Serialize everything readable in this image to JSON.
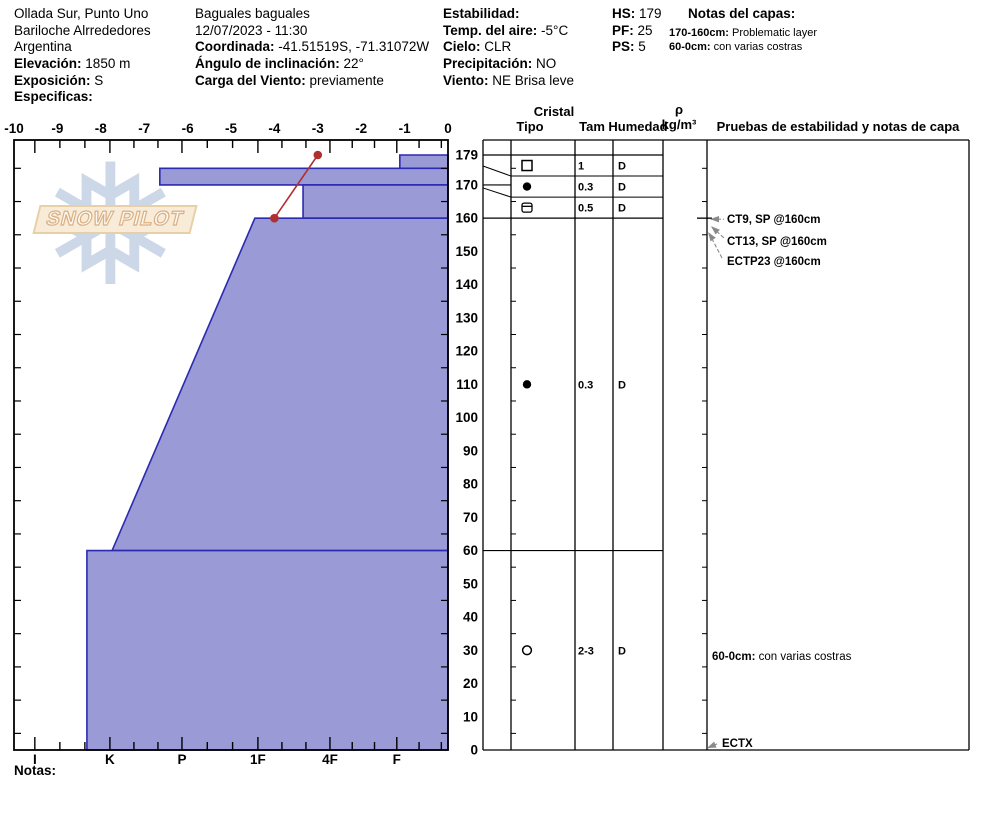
{
  "header": {
    "location": {
      "name": "Ollada Sur, Punto Uno",
      "region": "Bariloche Alrrededores",
      "country": "Argentina",
      "elevation_label": "Elevación:",
      "elevation_value": "1850 m",
      "aspect_label": "Exposición:",
      "aspect_value": "S",
      "specifics_label": "Especificas:"
    },
    "observation": {
      "title": "Baguales baguales",
      "datetime": "12/07/2023 - 11:30",
      "coord_label": "Coordinada:",
      "coord_value": "-41.51519S, -71.31072W",
      "slope_label": "Ángulo de inclinación:",
      "slope_value": "22°",
      "windload_label": "Carga del Viento:",
      "windload_value": "previamente"
    },
    "weather": {
      "stability_label": "Estabilidad:",
      "stability_value": "",
      "airtemp_label": "Temp. del aire:",
      "airtemp_value": "-5°C",
      "sky_label": "Cielo:",
      "sky_value": "CLR",
      "precip_label": "Precipitación:",
      "precip_value": "NO",
      "wind_label": "Viento:",
      "wind_value": "NE Brisa leve"
    },
    "totals": {
      "hs_label": "HS:",
      "hs_value": "179",
      "pf_label": "PF:",
      "pf_value": "25",
      "ps_label": "PS:",
      "ps_value": "5"
    },
    "layer_notes": {
      "title": "Notas del capas:",
      "notes": [
        {
          "label": "170-160cm:",
          "text": "Problematic layer"
        },
        {
          "label": "60-0cm:",
          "text": "con varias costras"
        }
      ]
    }
  },
  "watermark": {
    "flake_icon": "❅",
    "text": "SNOW PILOT"
  },
  "chart_data": {
    "type": "area",
    "title": "Snow pit profile: hardness vs height with temperature",
    "temp_axis": {
      "min": -10,
      "max": 0,
      "ticks": [
        -10,
        -9,
        -8,
        -7,
        -6,
        -5,
        -4,
        -3,
        -2,
        -1,
        0
      ]
    },
    "hardness_axis": {
      "categories": [
        {
          "label": "I",
          "u": -9.52
        },
        {
          "label": "K",
          "u": -7.79
        },
        {
          "label": "P",
          "u": -6.13
        },
        {
          "label": "1F",
          "u": -4.38
        },
        {
          "label": "4F",
          "u": -2.72
        },
        {
          "label": "F",
          "u": -1.18
        }
      ]
    },
    "depth_axis": {
      "unit": "cm",
      "max": 179,
      "labels": [
        179,
        170,
        160,
        150,
        140,
        130,
        120,
        110,
        100,
        90,
        80,
        70,
        60,
        50,
        40,
        30,
        20,
        10,
        0
      ],
      "minor_tick_start": 5,
      "minor_tick_step": 10
    },
    "layers": [
      {
        "top_cm": 179,
        "bottom_cm": 175,
        "hardness": "F",
        "u_top": -1.11,
        "u_bottom": -1.11
      },
      {
        "top_cm": 175,
        "bottom_cm": 170,
        "hardness": "P",
        "u_top": -6.64,
        "u_bottom": -6.64
      },
      {
        "top_cm": 170,
        "bottom_cm": 160,
        "hardness": "1F-4F",
        "u_top": -3.34,
        "u_bottom": -3.34
      },
      {
        "top_cm": 160,
        "bottom_cm": 60,
        "hardness": "1F-K",
        "u_top": -4.45,
        "u_bottom": -7.74
      },
      {
        "top_cm": 60,
        "bottom_cm": 0,
        "hardness": "K",
        "u_top": -8.32,
        "u_bottom": -8.32
      }
    ],
    "temperature_series": [
      {
        "depth_cm": 179,
        "temp_c": -3
      },
      {
        "depth_cm": 160,
        "temp_c": -4
      }
    ],
    "colors": {
      "layer_fill": "#9a9ad6",
      "layer_stroke": "#2b2bb0",
      "temperature": "#b03030",
      "axis": "#000000",
      "arrow": "#8a8a8a"
    }
  },
  "panel": {
    "headers": {
      "crystal": "Cristal",
      "type": "Tipo",
      "size": "Tam",
      "moisture": "Humedad",
      "density": "ρ",
      "density_unit": "kg/m³",
      "tests": "Pruebas de estabilidad y notas de capa"
    },
    "rows": [
      {
        "symbol": "square-open",
        "size": "1",
        "moisture": "D"
      },
      {
        "symbol": "circle-filled",
        "size": "0.3",
        "moisture": "D"
      },
      {
        "symbol": "crust",
        "size": "0.5",
        "moisture": "D"
      },
      {
        "symbol": "circle-filled",
        "size": "0.3",
        "moisture": "D"
      },
      {
        "symbol": "circle-open",
        "size": "2-3",
        "moisture": "D"
      }
    ],
    "tests": [
      {
        "label": "CT9, SP @160cm",
        "depth_cm": 160
      },
      {
        "label": "CT13, SP @160cm",
        "depth_cm": 160
      },
      {
        "label": "ECTP23 @160cm",
        "depth_cm": 160
      }
    ],
    "note": {
      "label": "60-0cm:",
      "text": "con varias costras"
    },
    "bottom_test": {
      "label": "ECTX",
      "depth_cm": 0
    }
  },
  "footer": {
    "notes_label": "Notas:"
  }
}
